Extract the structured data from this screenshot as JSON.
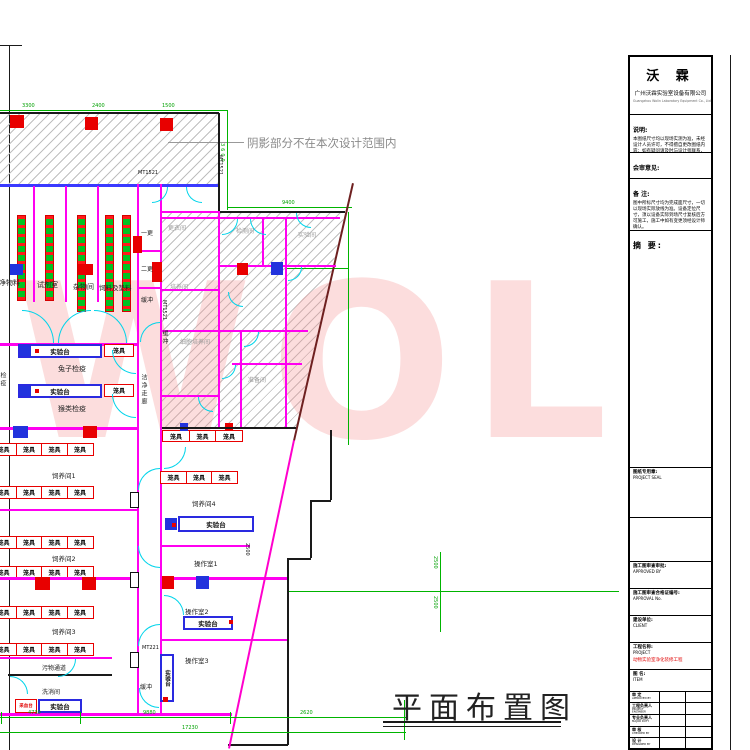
{
  "note": "阴影部分不在本次设计范围内",
  "drawing_title": "平面布置图",
  "watermark": "WOL",
  "labels": {
    "cage": "笼具",
    "bench": "实验台",
    "buffer": "缓冲",
    "blood_bench": "采血台"
  },
  "rooms": {
    "clean_material": "洁净物料",
    "reagent": "试剂室",
    "sundry": "杂物间",
    "feed_bedding": "饲料及垫料",
    "change1": "一更",
    "change2": "二更",
    "rabbit": "兔子检疫",
    "monkey": "猴类检疫",
    "quarantine": "检疫",
    "clean_corridor": "洁净走廊",
    "feeding1": "饲养间1",
    "feeding2": "饲养间2",
    "feeding3": "饲养间3",
    "feeding4": "饲养间4",
    "op1": "操作室1",
    "op2": "操作室2",
    "op3": "操作室3",
    "dirty_corridor": "污物通道",
    "wash": "洗消间"
  },
  "hatch_rooms": {
    "r1": "更衣间",
    "r2": "检测间",
    "r3": "实验间",
    "r4": "培养间",
    "r5": "细胞培养间",
    "r6": "准备间"
  },
  "door_tags": {
    "t1": "MT1521",
    "t2": "MT1521",
    "t3": "MT1521",
    "t4": "MT221"
  },
  "dims": {
    "top1": "3300",
    "top2": "2400",
    "top3": "1500",
    "v_left": "3600",
    "w9400": "9400",
    "s2500a": "2500",
    "s2500b": "2500",
    "diag": "2500",
    "b1": "4730",
    "b2": "9880",
    "b3": "2620",
    "total": "17230"
  },
  "title_block": {
    "logo": "沃 霖",
    "company": "广州沃霖实验室设备有限公司",
    "company_en": "Guangzhou Wolin Laboratory Equipment Co., Ltd",
    "notes_label": "说明:",
    "notes_text": "本图纸尺寸均以现场实测为准，未经设计人员许可，不得擅自更改图纸内容；如有疑问请及时与设计师联系，以便协商解决。",
    "review_label": "会审意见:",
    "remark_label": "备 注:",
    "remark_text": "图中所标尺寸均为完成面尺寸，一切以现场实际放线为准。设备定位尺寸，须以设备实际到场尺寸复核后方可施工，施工中如有变更须经设计师确认。",
    "abstract_label": "摘 要:",
    "seal_label": "图纸专用章:",
    "seal_en": "PROJECT SEAL",
    "approved_label": "施工图审查审批:",
    "approved_en": "APPROVED BY",
    "approval_no_label": "施工图审查合格证编号:",
    "approval_no_en": "APPROVAL No.",
    "client_label": "建设单位:",
    "client_en": "CLIENT",
    "project_label": "工程名称:",
    "project_en": "PROJECT",
    "project_value": "动物实验室净化装修工程",
    "item_label": "图 名:",
    "item_en": "ITEM",
    "sign_rows": [
      {
        "cn": "审 定",
        "en": "APPROVED BY"
      },
      {
        "cn": "工程负责人",
        "en": "PROJECT ENGINEER"
      },
      {
        "cn": "专业负责人",
        "en": "MAJOR DUTY"
      },
      {
        "cn": "审 核",
        "en": "CHECKED BY"
      },
      {
        "cn": "设 计",
        "en": "DESIGNED BY"
      }
    ]
  }
}
